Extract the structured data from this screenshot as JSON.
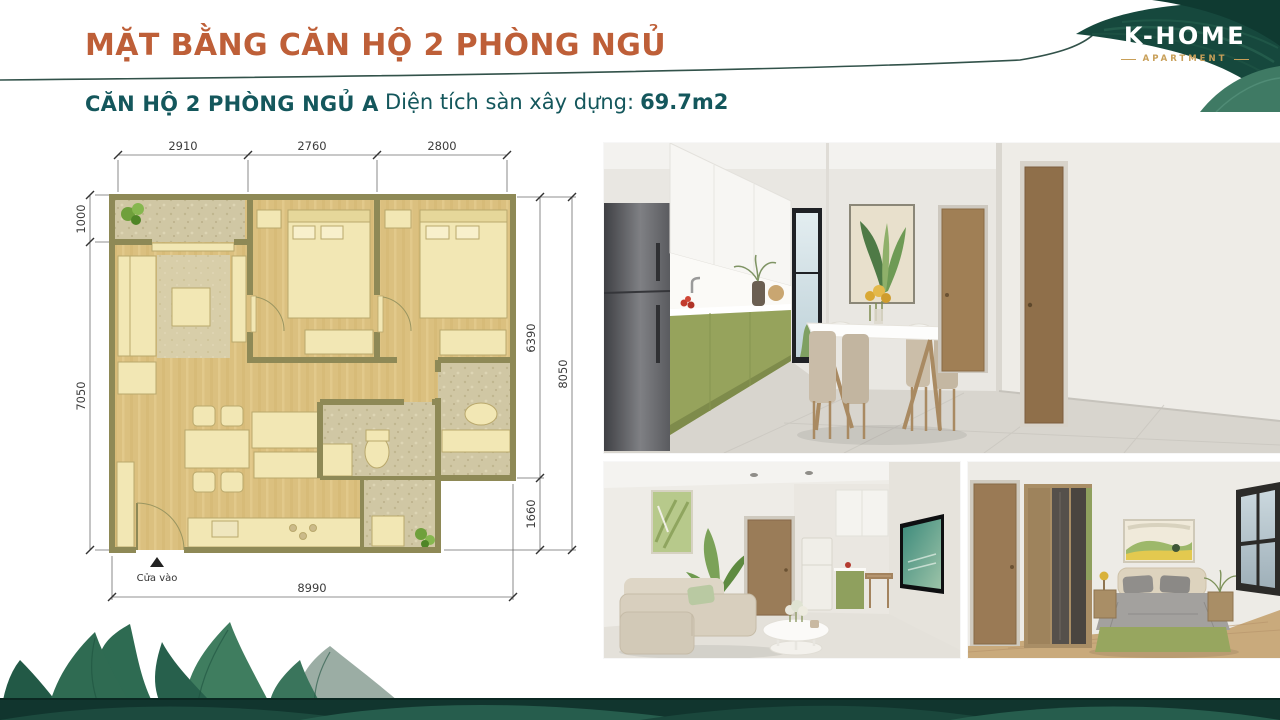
{
  "header": {
    "title": "MẶT BẰNG CĂN HỘ 2 PHÒNG NGỦ",
    "unit_label": "CĂN HỘ 2 PHÒNG NGỦ A",
    "area_label": "Diện tích sàn xây dựng:",
    "area_value": "69.7m2"
  },
  "logo": {
    "brand": "K-HOME",
    "subtitle": "APARTMENT"
  },
  "floor_plan": {
    "entrance_label": "Cửa vào",
    "dims": {
      "top": [
        "2910",
        "2760",
        "2800"
      ],
      "left": [
        "1000",
        "7050"
      ],
      "right": [
        "6390",
        "1660",
        "8050"
      ],
      "bottom": [
        "8990"
      ]
    }
  },
  "colors": {
    "accent_orange": "#BE5F38",
    "accent_teal": "#14575C",
    "divider_line": "#32524A",
    "wall_olive": "#8E8956",
    "floor_wheat": "#DBC07F",
    "furniture_cream": "#F2E7B4",
    "cabinet_green": "#96A35C",
    "logo_gold": "#C89F58",
    "leaf_dark": "#16483D"
  }
}
